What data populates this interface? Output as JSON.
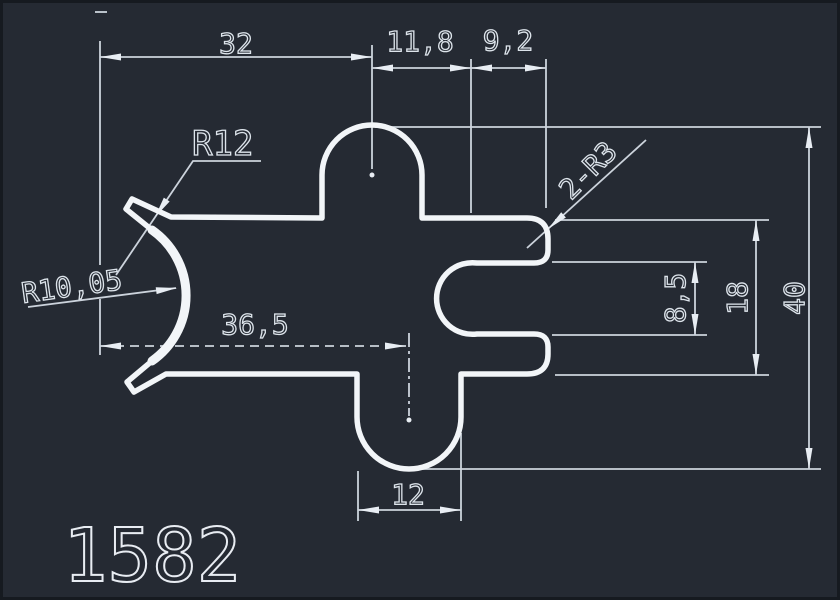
{
  "drawing": {
    "part_number": "1582",
    "dimensions": {
      "width_left": "32",
      "width_bump": "11,8",
      "width_slot": "9,2",
      "radius_outer": "R12",
      "radius_corners": "2-R3",
      "radius_inner": "R10,05",
      "width_mid": "36,5",
      "height_slot": "8,5",
      "height_inner": "18",
      "height_total": "40",
      "width_bottom_bump": "12"
    },
    "colors": {
      "background": "#252a33",
      "profile_line": "#f2f5f8",
      "dimension_line": "#ccd3dc",
      "text": "#dde4eb"
    }
  }
}
